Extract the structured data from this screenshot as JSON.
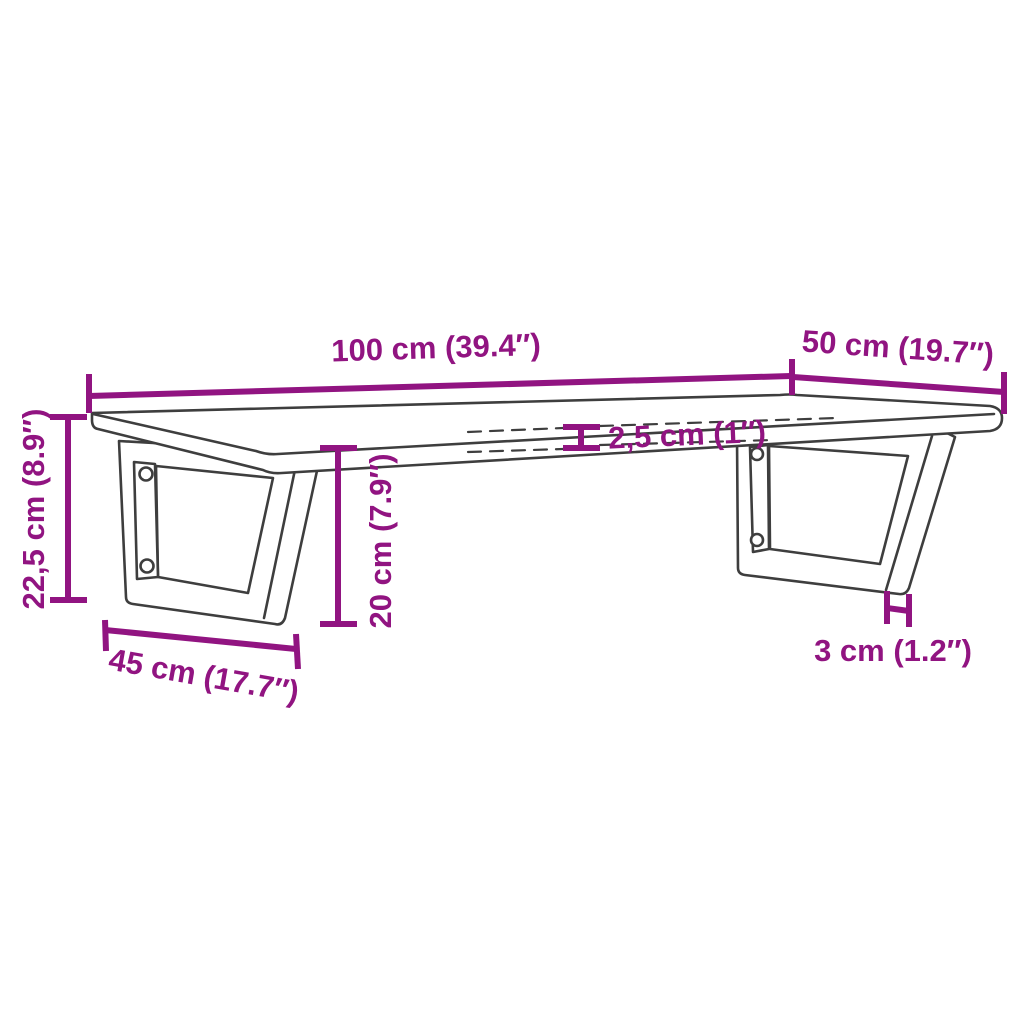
{
  "diagram": {
    "kind": "furniture-dimension-drawing",
    "colors": {
      "dimension_accent": "#911481",
      "outline": "#3E3E3E",
      "background": "#FFFFFF"
    },
    "dimensions": {
      "shelf_width": {
        "label": "100 cm (39.4″)",
        "cm": 100,
        "inches": 39.4
      },
      "shelf_depth": {
        "label": "50 cm (19.7″)",
        "cm": 50,
        "inches": 19.7
      },
      "shelf_thickness": {
        "label": "2,5 cm (1″)",
        "cm": 2.5,
        "inches": 1
      },
      "overall_height": {
        "label": "22,5 cm (8.9″)",
        "cm": 22.5,
        "inches": 8.9
      },
      "bracket_height": {
        "label": "20 cm (7.9″)",
        "cm": 20,
        "inches": 7.9
      },
      "bracket_base": {
        "label": "45 cm (17.7″)",
        "cm": 45,
        "inches": 17.7
      },
      "bracket_profile": {
        "label": "3 cm (1.2″)",
        "cm": 3,
        "inches": 1.2
      }
    }
  }
}
